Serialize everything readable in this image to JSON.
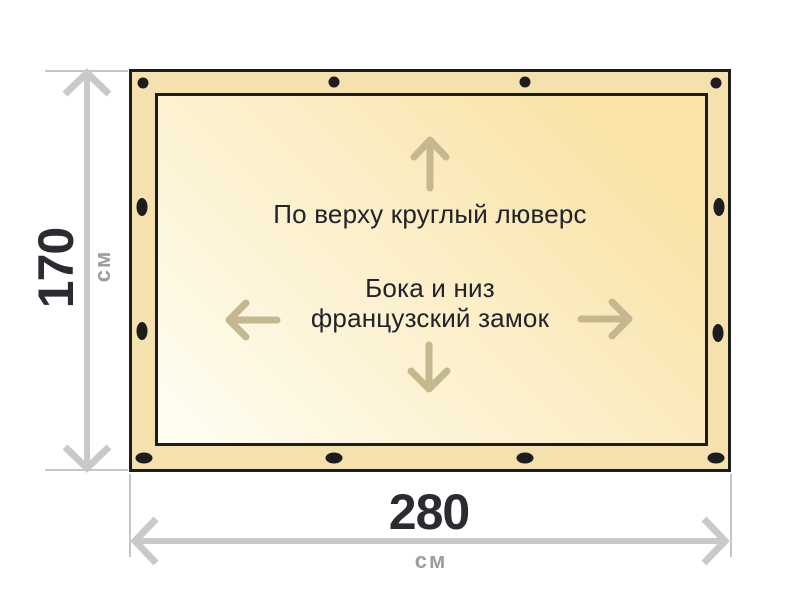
{
  "colors": {
    "page_bg": "#ffffff",
    "outline": "#1d1d20",
    "flap": "#f4e1ae",
    "panel_light": "#fffef4",
    "panel_shade": "#f9e3a8",
    "dim_line": "#c9c9c9",
    "ext_line": "#c6c6c6",
    "dir_arrow": "#c5b88f",
    "label_text": "#222228",
    "num_text": "#2b2b31",
    "unit_text": "#9d9d9d"
  },
  "tarp": {
    "top_note": "По верху круглый люверс",
    "center_note_line1": "Бока и низ",
    "center_note_line2": "французский замок"
  },
  "dimensions": {
    "height": {
      "value": "170",
      "unit": "см"
    },
    "width": {
      "value": "280",
      "unit": "см"
    }
  },
  "icons": {
    "grommet": "grommet-dot-icon",
    "up": "arrow-up-icon",
    "down": "arrow-down-icon",
    "left": "arrow-left-icon",
    "right": "arrow-right-icon"
  }
}
